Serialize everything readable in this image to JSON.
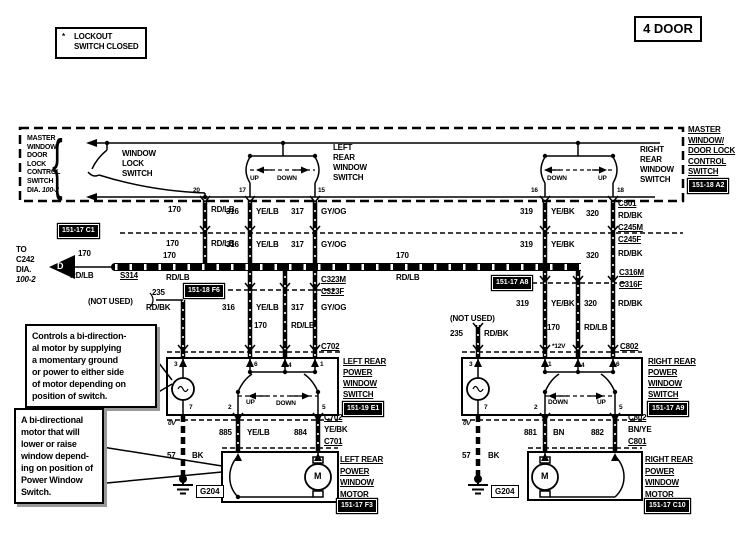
{
  "legend": {
    "star": "*",
    "line1": "LOCKOUT",
    "line2": "SWITCH CLOSED"
  },
  "door_tag": "4 DOOR",
  "brace": "{",
  "master": {
    "left_name": [
      "MASTER",
      "WINDOW",
      "DOOR",
      "LOCK",
      "CONTROL",
      "SWITCH"
    ],
    "dia_label": "DIA.",
    "dia_value": "100-2",
    "window_lock": [
      "WINDOW",
      "LOCK",
      "SWITCH"
    ],
    "left_rear": [
      "LEFT",
      "REAR",
      "WINDOW",
      "SWITCH"
    ],
    "right_rear": [
      "RIGHT",
      "REAR",
      "WINDOW",
      "SWITCH"
    ],
    "right_name": [
      "MASTER",
      "WINDOW/",
      "DOOR LOCK",
      "CONTROL",
      "SWITCH"
    ],
    "right_badge": "151-18 A2"
  },
  "dir": {
    "up": "UP",
    "down": "DOWN"
  },
  "pins": {
    "p1": "1",
    "p2": "2",
    "p3": "3",
    "p4": "4",
    "p5": "5",
    "p6": "6",
    "p7": "7",
    "p15": "15",
    "p16": "16",
    "p17": "17",
    "p18": "18",
    "p20": "20"
  },
  "wires": {
    "g170": "170",
    "rdlb": "RD/LB",
    "g316": "316",
    "yelb": "YE/LB",
    "g317": "317",
    "gyog": "GY/OG",
    "g319": "319",
    "yebk": "YE/BK",
    "g320": "320",
    "rdbk": "RD/BK",
    "g235": "235",
    "g57": "57",
    "bk": "BK",
    "g885": "885",
    "g884": "884",
    "g881": "881",
    "bn": "BN",
    "g882": "882",
    "bnye": "BN/YE"
  },
  "connectors": {
    "c501": "C501",
    "c245m": "C245M",
    "c245f": "C245F",
    "c316m": "C316M",
    "c316f": "C316F",
    "c323m": "C323M",
    "c323f": "C323F",
    "c702": "C702",
    "c701": "C701",
    "c802": "C802",
    "c801": "C801",
    "s314": "S314",
    "g204": "G204"
  },
  "badges": {
    "c1": "151-17 C1",
    "f6": "151-18 F6",
    "a8": "151-17 A8",
    "e1": "151-19 E1",
    "a9": "151-17 A9",
    "f3": "151-17 F3",
    "c10": "151-17 C10"
  },
  "labels": {
    "to_c242": [
      "TO",
      "C242",
      "DIA.",
      "100-2"
    ],
    "not_used": "(NOT USED)",
    "v0": "0V",
    "v12": "*12V",
    "d": "D",
    "m": "M",
    "left_power_switch": [
      "LEFT REAR",
      "POWER",
      "WINDOW",
      "SWITCH"
    ],
    "right_power_switch": [
      "RIGHT REAR",
      "POWER",
      "WINDOW",
      "SWITCH"
    ],
    "left_motor": [
      "LEFT REAR",
      "POWER",
      "WINDOW",
      "MOTOR"
    ],
    "right_motor": [
      "RIGHT REAR",
      "POWER",
      "WINDOW",
      "MOTOR"
    ]
  },
  "notes": {
    "switch_note": [
      "Controls a bi-direction-",
      "al motor by supplying",
      "a momentary ground",
      "or power to either side",
      "of motor depending on",
      "position of switch."
    ],
    "motor_note": [
      "A bi-directional",
      "motor that will",
      "lower or raise",
      "window depend-",
      "ing on position of",
      "Power Window",
      "Switch."
    ]
  }
}
